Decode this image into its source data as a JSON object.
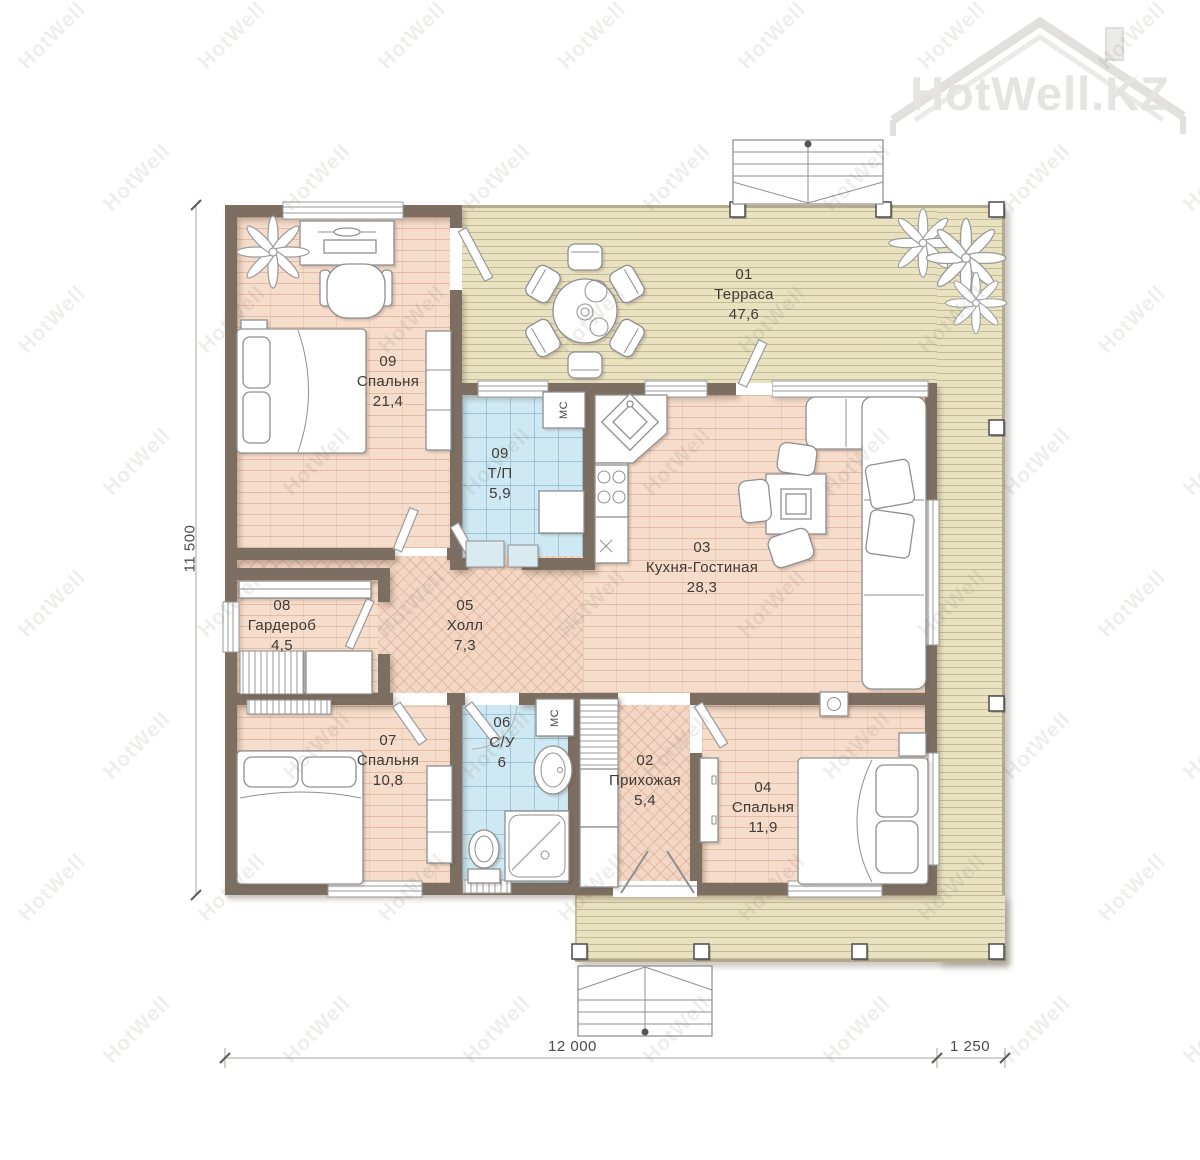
{
  "brand": {
    "logo_text": "HotWell.KZ",
    "watermark_text": "HotWell"
  },
  "rooms": [
    {
      "number": "01",
      "name": "Терраса",
      "area": "47,6"
    },
    {
      "number": "09",
      "name": "Спальня",
      "area": "21,4"
    },
    {
      "number": "09",
      "name": "Т/П",
      "area": "5,9"
    },
    {
      "number": "03",
      "name": "Кухня-Гостиная",
      "area": "28,3"
    },
    {
      "number": "08",
      "name": "Гардероб",
      "area": "4,5"
    },
    {
      "number": "05",
      "name": "Холл",
      "area": "7,3"
    },
    {
      "number": "07",
      "name": "Спальня",
      "area": "10,8"
    },
    {
      "number": "06",
      "name": "С/У",
      "area": "6"
    },
    {
      "number": "02",
      "name": "Прихожая",
      "area": "5,4"
    },
    {
      "number": "04",
      "name": "Спальня",
      "area": "11,9"
    }
  ],
  "appliances": {
    "washer_tp": "МС",
    "washer_bath": "МС"
  },
  "dimensions": {
    "left": "11 500",
    "bottom_main": "12 000",
    "bottom_right": "1 250"
  },
  "colors": {
    "wall": "#7d6e62",
    "floor_brick": "#f6dcca",
    "floor_tile": "#cfe9f4",
    "deck": "#e9e2c1",
    "label_text": "#3f3a36"
  }
}
